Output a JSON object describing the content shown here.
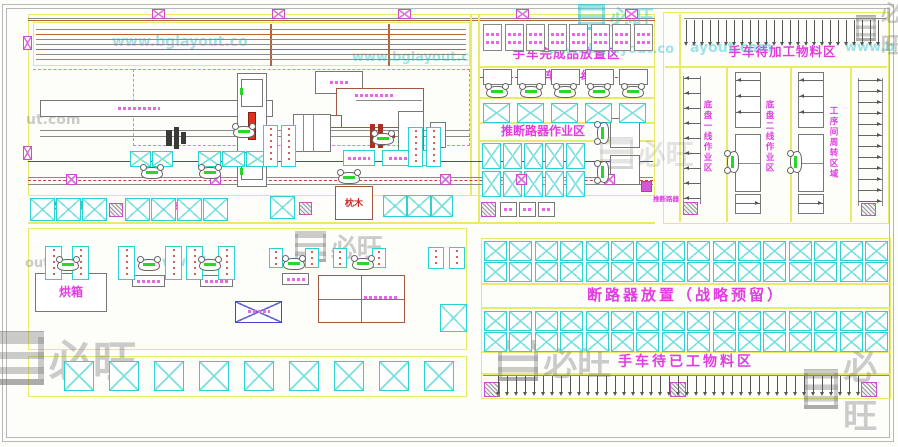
{
  "zones": {
    "finished_goods": "手车完成品放置区",
    "assembly_line": "手车装机线",
    "breaker_push_area": "推断路器作业区",
    "breaker_push_small": "推断路器",
    "incoming_material": "手车待加工物料区",
    "chassis_line1": "底盘一线作业区",
    "chassis_line2": "底盘二线作业区",
    "process_transfer": "工序间周转区域",
    "busbar_wait_left": "待外协铜排",
    "busbar_wait_right": "待外协铜排",
    "sleeper": "枕木",
    "temp_storage": "暂放区",
    "oven": "烘箱",
    "breaker_reserve": "断路器放置（战略预留）",
    "processed_material": "手车待已工物料区"
  },
  "watermark": {
    "brand": "必旺",
    "url": "www.bglayout.com",
    "fragments": [
      "www.bglayout.co",
      "www.bglayout.c",
      "ayout.com",
      "ut.com",
      "out.com",
      "www.bgla",
      "www.b"
    ]
  }
}
